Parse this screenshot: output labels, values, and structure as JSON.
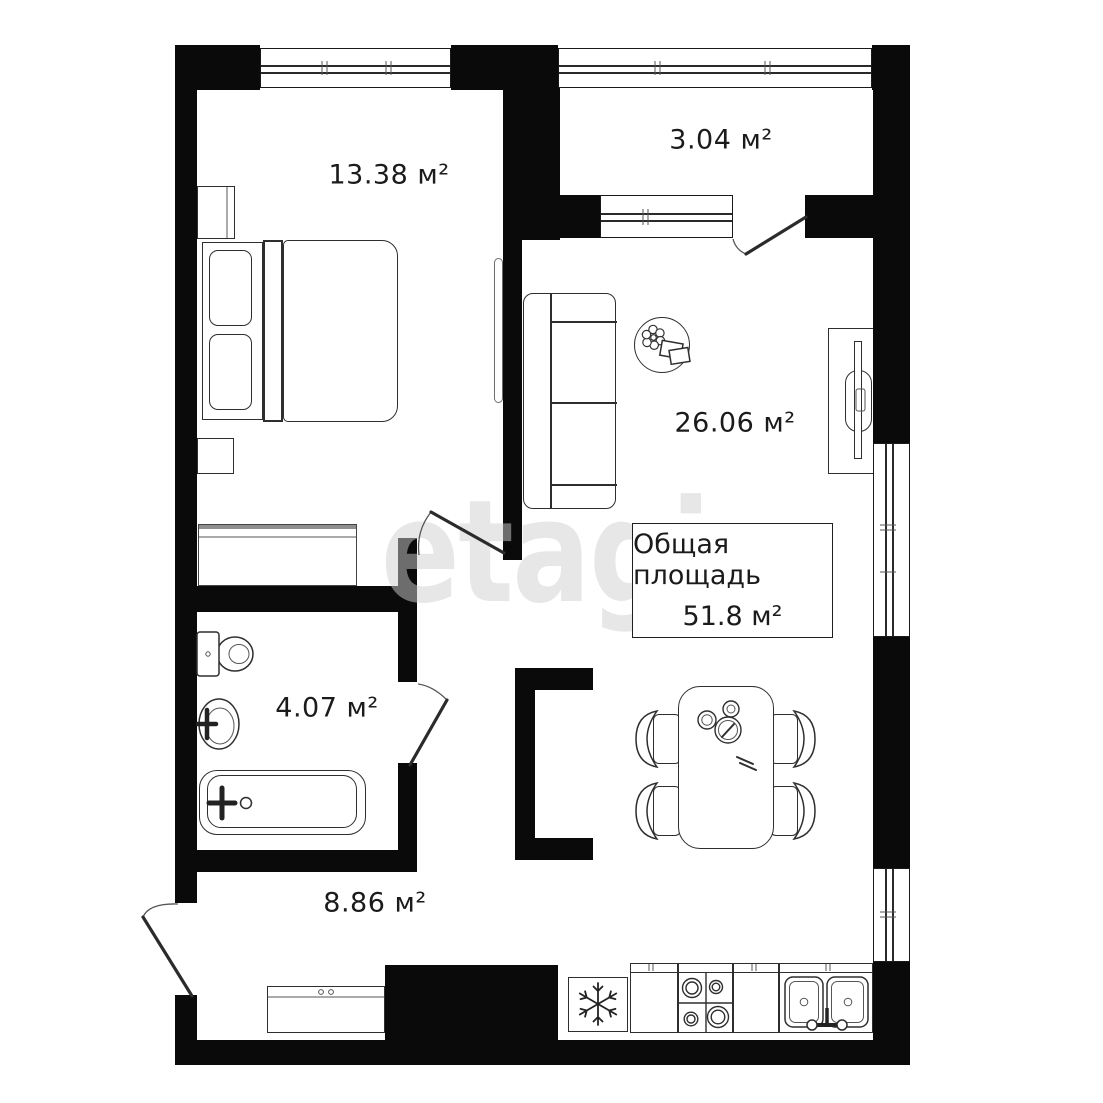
{
  "colors": {
    "wall": "#0a0a0a",
    "furniture_line": "#2e2e2e",
    "text": "#1b1b1b",
    "watermark": "#d0d0d0",
    "background": "#ffffff"
  },
  "watermark": "etagi",
  "rooms": {
    "bedroom": {
      "area": "13.38 м²"
    },
    "balcony": {
      "area": "3.04 м²"
    },
    "living": {
      "area": "26.06 м²"
    },
    "bathroom": {
      "area": "4.07 м²"
    },
    "hallway": {
      "area": "8.86 м²"
    }
  },
  "total": {
    "label": "Общая площадь",
    "value": "51.8 м²"
  },
  "furniture_icons": [
    "bed-icon",
    "pillow-icon",
    "nightstand-icon",
    "wardrobe-icon",
    "sliding-door-icon",
    "sofa-icon",
    "round-table-icon",
    "flower-icon",
    "books-icon",
    "tv-unit-icon",
    "dining-table-icon",
    "chair-icon",
    "plate-icon",
    "cup-icon",
    "toilet-icon",
    "washbasin-icon",
    "bathtub-icon",
    "faucet-icon",
    "fridge-snowflake-icon",
    "stove-burners-icon",
    "double-sink-icon",
    "shoe-cabinet-icon",
    "door-swing-icon",
    "window-icon",
    "vent-column-icon"
  ]
}
